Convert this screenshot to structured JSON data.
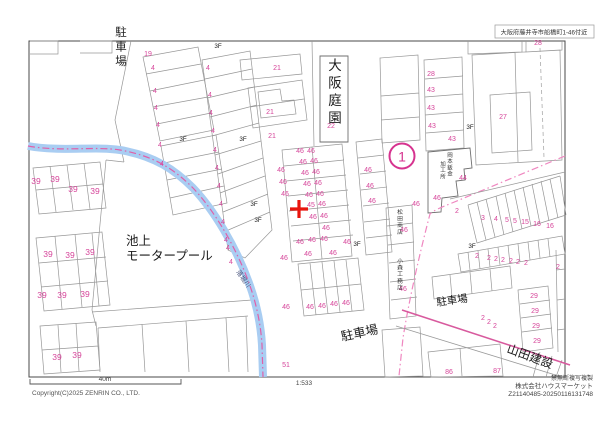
{
  "header": {
    "area_label": "大阪府藤井寺市船橋町1-46付近"
  },
  "map": {
    "marker": {
      "label": "1"
    },
    "target_cross": {
      "x": 299,
      "y": 209
    },
    "floor_label": "3F",
    "floor_positions": [
      {
        "x": 218,
        "y": 48
      },
      {
        "x": 183,
        "y": 141
      },
      {
        "x": 243,
        "y": 141
      },
      {
        "x": 254,
        "y": 206
      },
      {
        "x": 258,
        "y": 222
      },
      {
        "x": 357,
        "y": 246
      },
      {
        "x": 470,
        "y": 129
      },
      {
        "x": 472,
        "y": 248
      }
    ],
    "landmark_labels": [
      {
        "t": "駐車場",
        "x": 121,
        "y": 36,
        "size": 11.5,
        "orient": "v",
        "spacing": 14.5,
        "color": "#222222"
      },
      {
        "t": "大阪庭園",
        "x": 335,
        "y": 70,
        "size": 13.5,
        "orient": "v",
        "spacing": 17.5,
        "color": "#1a1a1a"
      },
      {
        "t": "池上",
        "x": 126,
        "y": 245,
        "size": 12.5,
        "orient": "h",
        "color": "#1a1a1a"
      },
      {
        "t": "モータープール",
        "x": 126,
        "y": 260,
        "size": 12.5,
        "orient": "h",
        "color": "#1a1a1a"
      },
      {
        "t": "駐車場",
        "x": 342,
        "y": 341,
        "size": 12.5,
        "orient": "h",
        "rotate": -12,
        "color": "#1a1a1a"
      },
      {
        "t": "駐車場",
        "x": 437,
        "y": 306,
        "size": 10.5,
        "orient": "h",
        "rotate": -8,
        "color": "#1a1a1a"
      },
      {
        "t": "山田建設",
        "x": 506,
        "y": 352,
        "size": 12,
        "orient": "h",
        "rotate": 20,
        "color": "#1a1a1a"
      },
      {
        "t": "松田商店",
        "x": 400,
        "y": 214,
        "size": 5.8,
        "orient": "v",
        "spacing": 6.6,
        "color": "#333333"
      },
      {
        "t": "小森工務店",
        "x": 400,
        "y": 263,
        "size": 5.8,
        "orient": "v",
        "spacing": 6.6,
        "color": "#333333"
      },
      {
        "t": "岡本鈑金",
        "x": 450,
        "y": 157,
        "size": 5.5,
        "orient": "v",
        "spacing": 6.2,
        "color": "#333333"
      },
      {
        "t": "加工所",
        "x": 443,
        "y": 166,
        "size": 5.5,
        "orient": "v",
        "spacing": 6.2,
        "color": "#333333"
      },
      {
        "t": "落堀川",
        "x": 236,
        "y": 272,
        "size": 6.5,
        "orient": "h",
        "rotate": 55,
        "color": "#45507a"
      }
    ],
    "lot_numbers": [
      {
        "t": "19",
        "x": 148,
        "y": 56
      },
      {
        "t": "4",
        "x": 153,
        "y": 70
      },
      {
        "t": "4",
        "x": 155,
        "y": 93
      },
      {
        "t": "4",
        "x": 156,
        "y": 110
      },
      {
        "t": "4",
        "x": 158,
        "y": 127
      },
      {
        "t": "4",
        "x": 160,
        "y": 147
      },
      {
        "t": "4",
        "x": 162,
        "y": 166
      },
      {
        "t": "4",
        "x": 208,
        "y": 70
      },
      {
        "t": "4",
        "x": 210,
        "y": 97
      },
      {
        "t": "4",
        "x": 211,
        "y": 115
      },
      {
        "t": "4",
        "x": 213,
        "y": 133
      },
      {
        "t": "4",
        "x": 215,
        "y": 152
      },
      {
        "t": "4",
        "x": 217,
        "y": 170
      },
      {
        "t": "4",
        "x": 219,
        "y": 188
      },
      {
        "t": "4",
        "x": 221,
        "y": 206
      },
      {
        "t": "4",
        "x": 223,
        "y": 224
      },
      {
        "t": "4",
        "x": 226,
        "y": 242
      },
      {
        "t": "4",
        "x": 228,
        "y": 250
      },
      {
        "t": "4",
        "x": 231,
        "y": 264
      },
      {
        "t": "21",
        "x": 277,
        "y": 70
      },
      {
        "t": "21",
        "x": 270,
        "y": 114
      },
      {
        "t": "21",
        "x": 272,
        "y": 138
      },
      {
        "t": "22",
        "x": 331,
        "y": 128
      },
      {
        "t": "28",
        "x": 538,
        "y": 45
      },
      {
        "t": "39",
        "x": 36,
        "y": 184,
        "s": 8.5
      },
      {
        "t": "39",
        "x": 55,
        "y": 182,
        "s": 8.5
      },
      {
        "t": "39",
        "x": 73,
        "y": 192,
        "s": 8.5
      },
      {
        "t": "39",
        "x": 95,
        "y": 194,
        "s": 8.5
      },
      {
        "t": "39",
        "x": 48,
        "y": 257,
        "s": 8.5
      },
      {
        "t": "39",
        "x": 70,
        "y": 258,
        "s": 8.5
      },
      {
        "t": "39",
        "x": 90,
        "y": 255,
        "s": 8.5
      },
      {
        "t": "39",
        "x": 42,
        "y": 298,
        "s": 8.5
      },
      {
        "t": "39",
        "x": 62,
        "y": 298,
        "s": 8.5
      },
      {
        "t": "39",
        "x": 85,
        "y": 297,
        "s": 8.5
      },
      {
        "t": "39",
        "x": 57,
        "y": 360,
        "s": 8.5
      },
      {
        "t": "39",
        "x": 77,
        "y": 358,
        "s": 8.5
      },
      {
        "t": "46",
        "x": 300,
        "y": 153
      },
      {
        "t": "46",
        "x": 311,
        "y": 153
      },
      {
        "t": "46",
        "x": 303,
        "y": 164
      },
      {
        "t": "46",
        "x": 314,
        "y": 163
      },
      {
        "t": "46",
        "x": 305,
        "y": 175
      },
      {
        "t": "46",
        "x": 316,
        "y": 174
      },
      {
        "t": "46",
        "x": 307,
        "y": 186
      },
      {
        "t": "46",
        "x": 318,
        "y": 185
      },
      {
        "t": "46",
        "x": 309,
        "y": 197
      },
      {
        "t": "46",
        "x": 320,
        "y": 196
      },
      {
        "t": "45",
        "x": 311,
        "y": 207
      },
      {
        "t": "46",
        "x": 322,
        "y": 206
      },
      {
        "t": "46",
        "x": 313,
        "y": 219
      },
      {
        "t": "46",
        "x": 324,
        "y": 218
      },
      {
        "t": "46",
        "x": 326,
        "y": 230
      },
      {
        "t": "46",
        "x": 281,
        "y": 172
      },
      {
        "t": "46",
        "x": 283,
        "y": 184
      },
      {
        "t": "46",
        "x": 285,
        "y": 196
      },
      {
        "t": "46",
        "x": 368,
        "y": 172
      },
      {
        "t": "46",
        "x": 370,
        "y": 188
      },
      {
        "t": "46",
        "x": 372,
        "y": 203
      },
      {
        "t": "46",
        "x": 300,
        "y": 244
      },
      {
        "t": "46",
        "x": 312,
        "y": 242
      },
      {
        "t": "46",
        "x": 324,
        "y": 241
      },
      {
        "t": "46",
        "x": 347,
        "y": 244
      },
      {
        "t": "46",
        "x": 308,
        "y": 256
      },
      {
        "t": "46",
        "x": 333,
        "y": 255
      },
      {
        "t": "46",
        "x": 310,
        "y": 309
      },
      {
        "t": "46",
        "x": 322,
        "y": 308
      },
      {
        "t": "46",
        "x": 334,
        "y": 306
      },
      {
        "t": "46",
        "x": 346,
        "y": 305
      },
      {
        "t": "46",
        "x": 284,
        "y": 260
      },
      {
        "t": "46",
        "x": 286,
        "y": 309
      },
      {
        "t": "51",
        "x": 286,
        "y": 367
      },
      {
        "t": "46",
        "x": 404,
        "y": 232
      },
      {
        "t": "46",
        "x": 403,
        "y": 291
      },
      {
        "t": "46",
        "x": 416,
        "y": 206
      },
      {
        "t": "46",
        "x": 437,
        "y": 200
      },
      {
        "t": "44",
        "x": 463,
        "y": 180
      },
      {
        "t": "28",
        "x": 431,
        "y": 76
      },
      {
        "t": "43",
        "x": 431,
        "y": 92
      },
      {
        "t": "43",
        "x": 431,
        "y": 110
      },
      {
        "t": "43",
        "x": 432,
        "y": 128
      },
      {
        "t": "43",
        "x": 452,
        "y": 141
      },
      {
        "t": "27",
        "x": 503,
        "y": 119
      },
      {
        "t": "2",
        "x": 457,
        "y": 213
      },
      {
        "t": "3",
        "x": 483,
        "y": 220
      },
      {
        "t": "4",
        "x": 496,
        "y": 221
      },
      {
        "t": "5",
        "x": 507,
        "y": 222
      },
      {
        "t": "5",
        "x": 515,
        "y": 223
      },
      {
        "t": "15",
        "x": 525,
        "y": 224
      },
      {
        "t": "16",
        "x": 537,
        "y": 226
      },
      {
        "t": "16",
        "x": 550,
        "y": 228
      },
      {
        "t": "2",
        "x": 477,
        "y": 258
      },
      {
        "t": "2",
        "x": 489,
        "y": 260
      },
      {
        "t": "2",
        "x": 496,
        "y": 261
      },
      {
        "t": "2",
        "x": 503,
        "y": 262
      },
      {
        "t": "2",
        "x": 511,
        "y": 263
      },
      {
        "t": "2",
        "x": 518,
        "y": 264
      },
      {
        "t": "2",
        "x": 526,
        "y": 265
      },
      {
        "t": "2",
        "x": 558,
        "y": 269
      },
      {
        "t": "29",
        "x": 534,
        "y": 298
      },
      {
        "t": "29",
        "x": 535,
        "y": 313
      },
      {
        "t": "29",
        "x": 536,
        "y": 328
      },
      {
        "t": "29",
        "x": 537,
        "y": 343
      },
      {
        "t": "2",
        "x": 483,
        "y": 320
      },
      {
        "t": "2",
        "x": 489,
        "y": 324
      },
      {
        "t": "2",
        "x": 495,
        "y": 328
      },
      {
        "t": "86",
        "x": 449,
        "y": 374
      },
      {
        "t": "87",
        "x": 497,
        "y": 373
      }
    ],
    "colors": {
      "lot_number": "#d6459a",
      "road_line": "#e87fba",
      "river": "#a9cdf2",
      "river_boundary": "#e060a8",
      "target_cross": "#e8150d",
      "marker": "#d6338f"
    }
  },
  "footer": {
    "scale_bar_label": "40m",
    "scale_ratio": "1:533",
    "copyright": "Copyright(C)2025 ZENRIN CO., LTD.",
    "rights_notice": "禁無断複写複製",
    "company": "株式会社ハウスマーケット",
    "serial": "Z21140485-20250116131748"
  }
}
